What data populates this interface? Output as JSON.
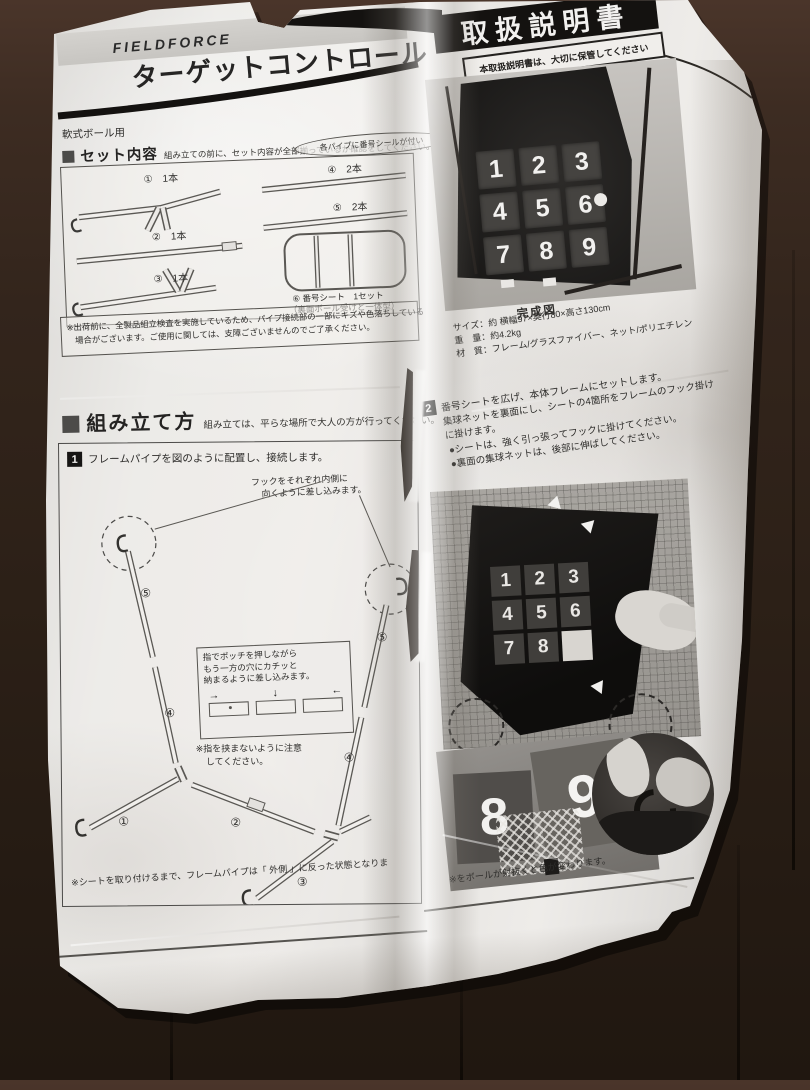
{
  "header": {
    "brand": "FIELDFORCE",
    "title": "ターゲットコントロール",
    "manual_banner": "取扱説明書",
    "keep_note": "本取扱説明書は、大切に保管してください",
    "ball_type": "軟式ボール用"
  },
  "set_contents": {
    "heading": "セット内容",
    "lead": "組み立ての前に、セット内容が全部揃っているか確認をしてください。",
    "sticker_note": "各パイプに番号シールが付い",
    "part1": "①　1本",
    "part2": "②　1本",
    "part3": "③　1本",
    "part4": "④　2本",
    "part5": "⑤　2本",
    "part6": "⑥ 番号シート　1セット",
    "part6_sub": "（裏面ボール受けと一体型）",
    "shipping_note1": "※出荷前に、全製品組立検査を実施しているため、パイプ接続部の一部にキズや色落ちしている",
    "shipping_note2": "場合がございます。ご使用に関しては、支障ございませんのでご了承ください。"
  },
  "completed": {
    "caption": "完成図",
    "spec_size": "サイズ：約 横幅97×奥行80×高さ130cm",
    "spec_weight": "重　量：約4.2kg",
    "spec_material": "材　質：フレーム/グラスファイバー、ネット/ポリエチレン"
  },
  "assembly": {
    "heading": "組み立て方",
    "lead": "組み立ては、平らな場所で大人の方が行ってください。"
  },
  "step1": {
    "num": "1",
    "title": "フレームパイプを図のように配置し、接続します。",
    "hook_note1": "フックをそれぞれ内側に",
    "hook_note2": "向くように差し込みます。",
    "push_note1": "指でポッチを押しながら",
    "push_note2": "もう一方の穴にカチッと",
    "push_note3": "納まるように差し込みます。",
    "pinch_note1": "※指を挟まないように注意",
    "pinch_note2": "してください。",
    "label_5l": "⑤",
    "label_4l": "④",
    "label_1": "①",
    "label_2": "②",
    "label_3": "③",
    "label_4r": "④",
    "label_5r": "⑤",
    "bottom_note": "※シートを取り付けるまで、フレームパイプは「 外側 」に反った状態となりま"
  },
  "step2": {
    "num": "2",
    "line1": "番号シートを広げ、本体フレームにセットします。",
    "line2": "集球ネットを裏面にし、シートの4箇所をフレームのフック掛け",
    "line3": "に掛けます。",
    "bullet1": "●シートは、強く引っ張ってフックに掛けてください。",
    "bullet2": "●裏面の集球ネットは、後部に伸ばしてください。",
    "color_note": "※をボールが射抜くと色が変わります。"
  },
  "numbers": [
    "1",
    "2",
    "3",
    "4",
    "5",
    "6",
    "7",
    "8",
    "9"
  ],
  "icons": {
    "arrow_right": "→",
    "arrow_down": "↓",
    "arrow_left": "←"
  },
  "colors": {
    "paper": "#e9e7e4",
    "floor": "#2c2017",
    "ink": "#2e2d2b"
  }
}
